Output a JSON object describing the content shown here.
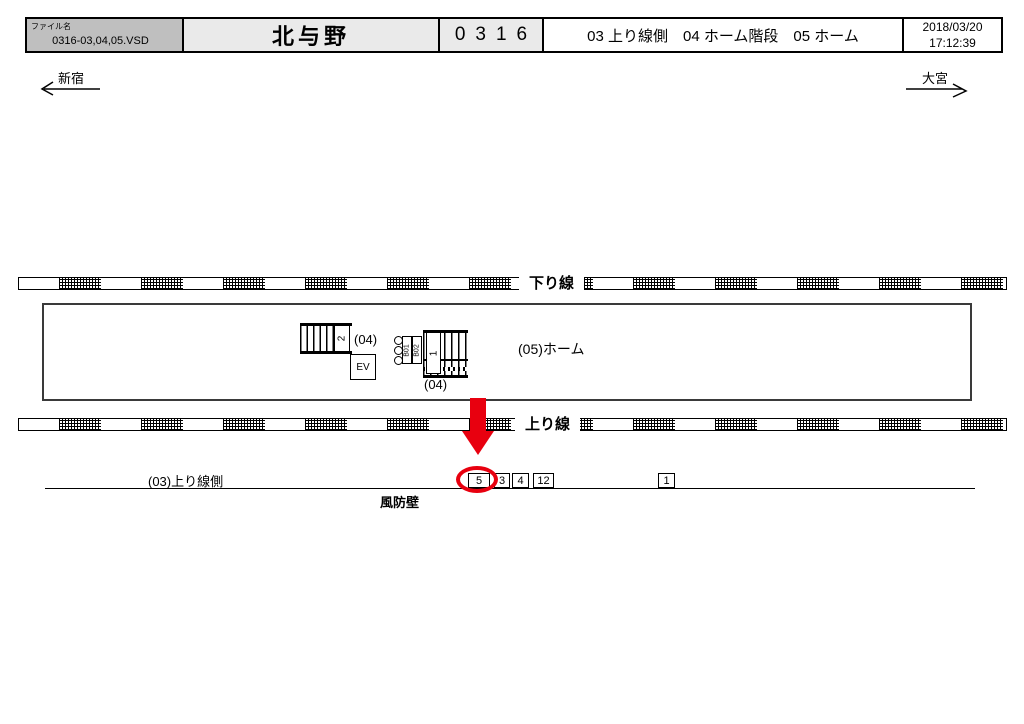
{
  "header": {
    "file_label": "ファイル名",
    "file_name": "0316-03,04,05.VSD",
    "station": "北与野",
    "number": "0316",
    "description": "03 上り線側　04 ホーム階段　05 ホーム",
    "date": "2018/03/20",
    "time": "17:12:39"
  },
  "directions": {
    "left": "新宿",
    "right": "大宮"
  },
  "diagram": {
    "down_line_label": "下り線",
    "up_line_label": "上り線",
    "platform_label": "(05)ホーム",
    "stair_left_label": "(04)",
    "stair_left_number": "2",
    "stair_right_label": "(04)",
    "stair_right_number": "1",
    "gate_b01": "B01",
    "gate_b02": "B02",
    "elevator_label": "EV",
    "upline_side_label": "(03)上り線側",
    "windbreak_label": "風防壁",
    "position_boxes": [
      "5",
      "3",
      "4",
      "12",
      "1"
    ],
    "highlight_color": "#e8000f"
  }
}
